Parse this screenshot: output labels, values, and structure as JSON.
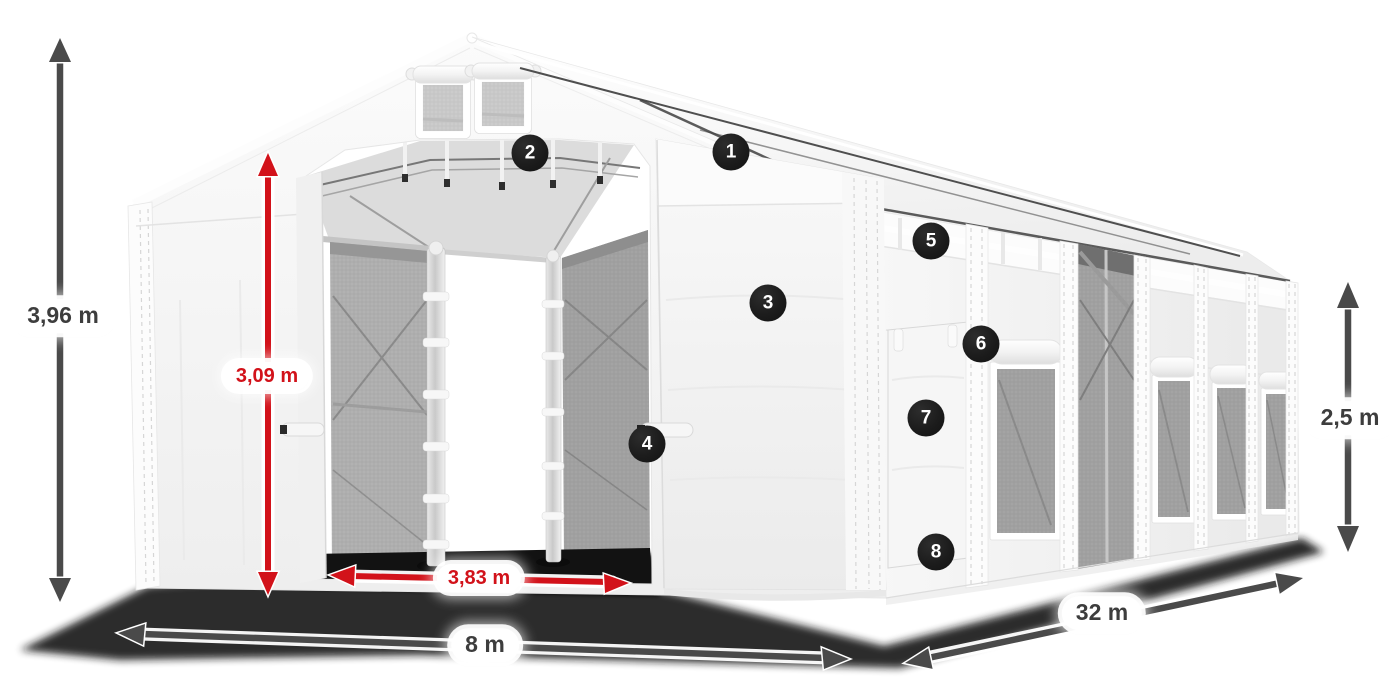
{
  "diagram": {
    "dimensions": {
      "total_height": "3,96 m",
      "entrance_height": "3,09 m",
      "entrance_width": "3,83 m",
      "front_width": "8 m",
      "side_length": "32 m",
      "side_height": "2,5 m"
    },
    "markers": [
      "1",
      "2",
      "3",
      "4",
      "5",
      "6",
      "7",
      "8"
    ],
    "colors": {
      "dimension_red": "#d2121a",
      "dimension_gray": "#4a4a4a",
      "label_text": "#3d3d3d",
      "marker_bg": "#1c1c1c",
      "marker_text": "#ffffff",
      "tent_white": "#f4f4f4",
      "mesh_gray": "#a8a8a8",
      "background": "#ffffff"
    }
  }
}
